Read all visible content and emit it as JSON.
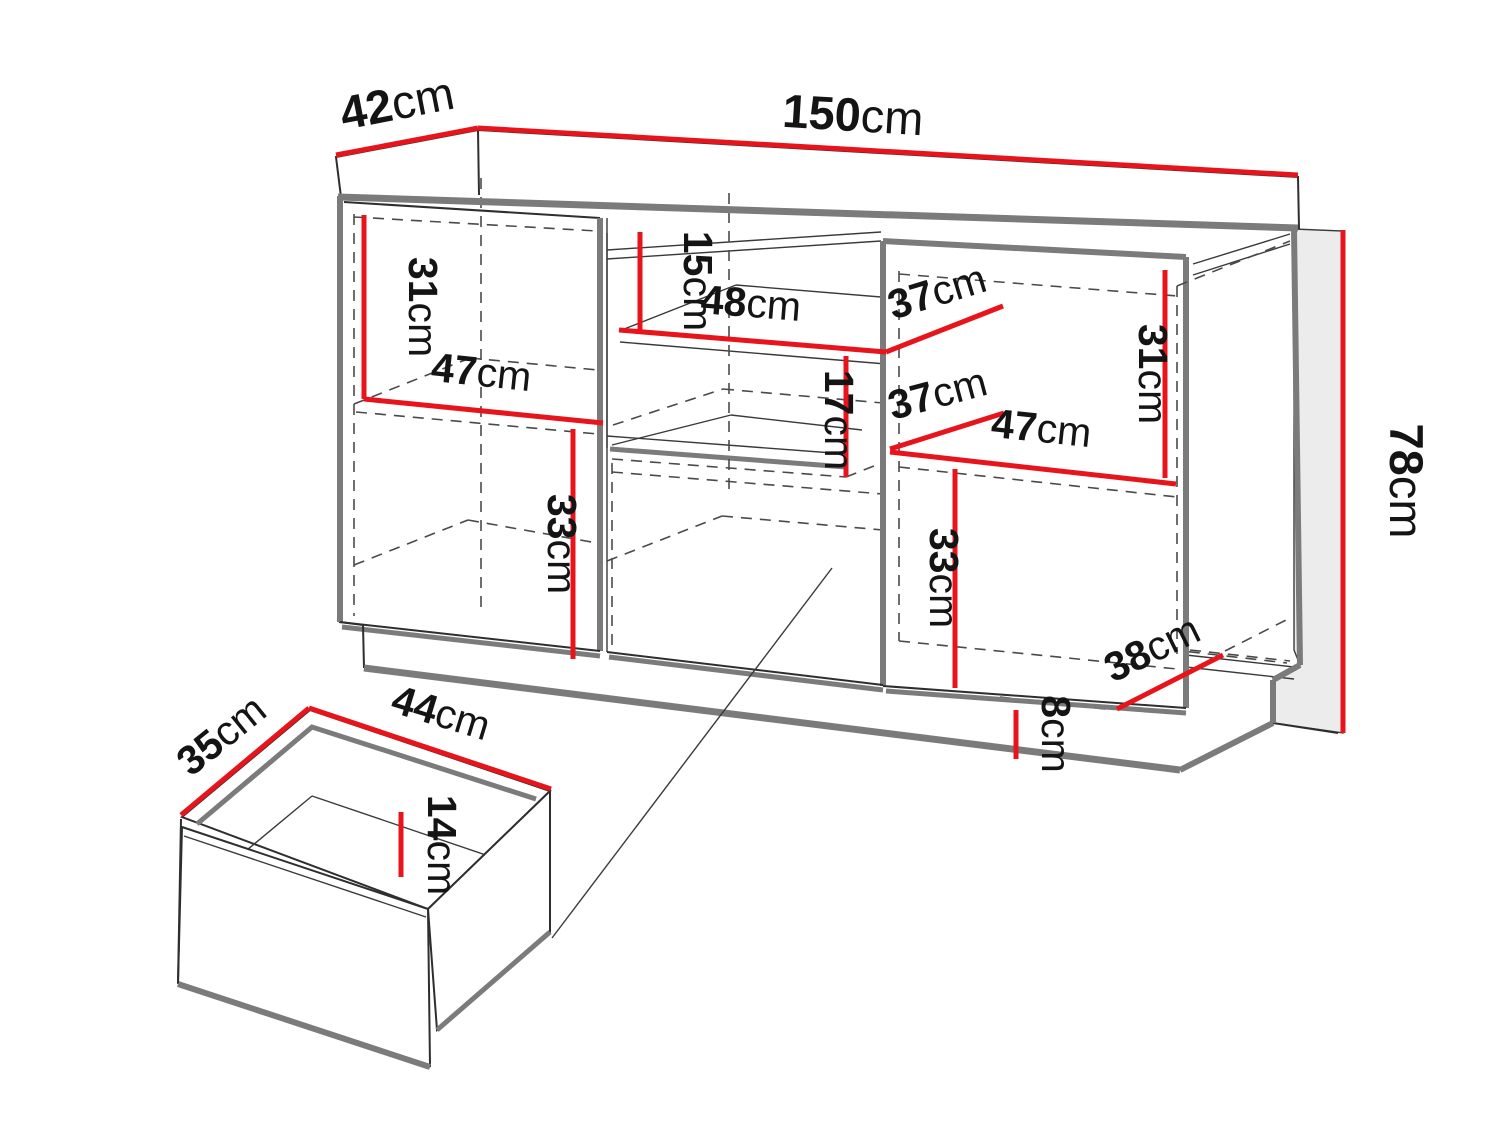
{
  "meta": {
    "description": "Technical dimension diagram of a sideboard cabinet with open shelves, two doors, plinth and a detail view of a drawer",
    "unit": "cm"
  },
  "colors": {
    "dimension_line": "#e8141b",
    "outline": "#2e2e2e",
    "shadow_edge": "#7b7b7b",
    "dashed_line": "#4a4a4a",
    "label_text": "#141414",
    "side_panel_fill": "#ececec",
    "background": "#ffffff"
  },
  "dims": {
    "top_depth": {
      "value": "42",
      "unit": "cm"
    },
    "top_width": {
      "value": "150",
      "unit": "cm"
    },
    "height": {
      "value": "78",
      "unit": "cm"
    },
    "left_upper_height": {
      "value": "31",
      "unit": "cm"
    },
    "left_shelf_width": {
      "value": "47",
      "unit": "cm"
    },
    "left_lower_height": {
      "value": "33",
      "unit": "cm"
    },
    "middle_top_height": {
      "value": "15",
      "unit": "cm"
    },
    "middle_shelf_width": {
      "value": "48",
      "unit": "cm"
    },
    "middle_shelf_depth": {
      "value": "37",
      "unit": "cm"
    },
    "middle_mid_height": {
      "value": "17",
      "unit": "cm"
    },
    "right_shelf_depth": {
      "value": "37",
      "unit": "cm"
    },
    "right_shelf_width": {
      "value": "47",
      "unit": "cm"
    },
    "right_upper_height": {
      "value": "31",
      "unit": "cm"
    },
    "right_lower_height": {
      "value": "33",
      "unit": "cm"
    },
    "bottom_depth": {
      "value": "38",
      "unit": "cm"
    },
    "plinth_height": {
      "value": "8",
      "unit": "cm"
    },
    "drawer_depth": {
      "value": "35",
      "unit": "cm"
    },
    "drawer_width": {
      "value": "44",
      "unit": "cm"
    },
    "drawer_height": {
      "value": "14",
      "unit": "cm"
    }
  }
}
